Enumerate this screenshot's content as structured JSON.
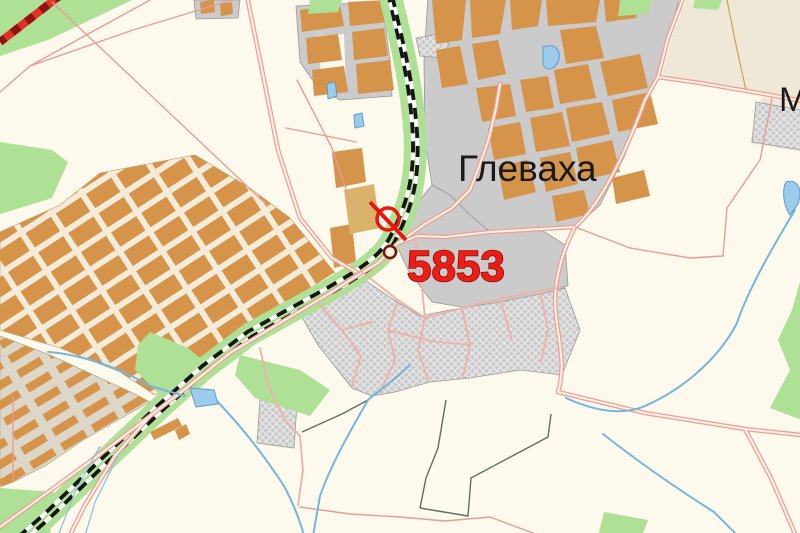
{
  "map": {
    "labels": {
      "town": "Глеваха",
      "waypoint": "5853",
      "edge_partial": "М"
    },
    "waypoint": {
      "id": "5853",
      "symbol": "crossed-circle-marker",
      "color": "#E81810"
    },
    "legend_colors": {
      "background": "#FDF9EC",
      "field_beige": "#EFE8D6",
      "urban_gray": "#CBCBCB",
      "residential_block_orange": "#D6934A",
      "vegetation_green": "#AEE096",
      "water_blue": "#74B6DE",
      "road_pink": "#EE9E96",
      "railway_black": "#151515",
      "highway_red": "#E03028",
      "waypoint_label_red": "#EE1C14"
    }
  }
}
